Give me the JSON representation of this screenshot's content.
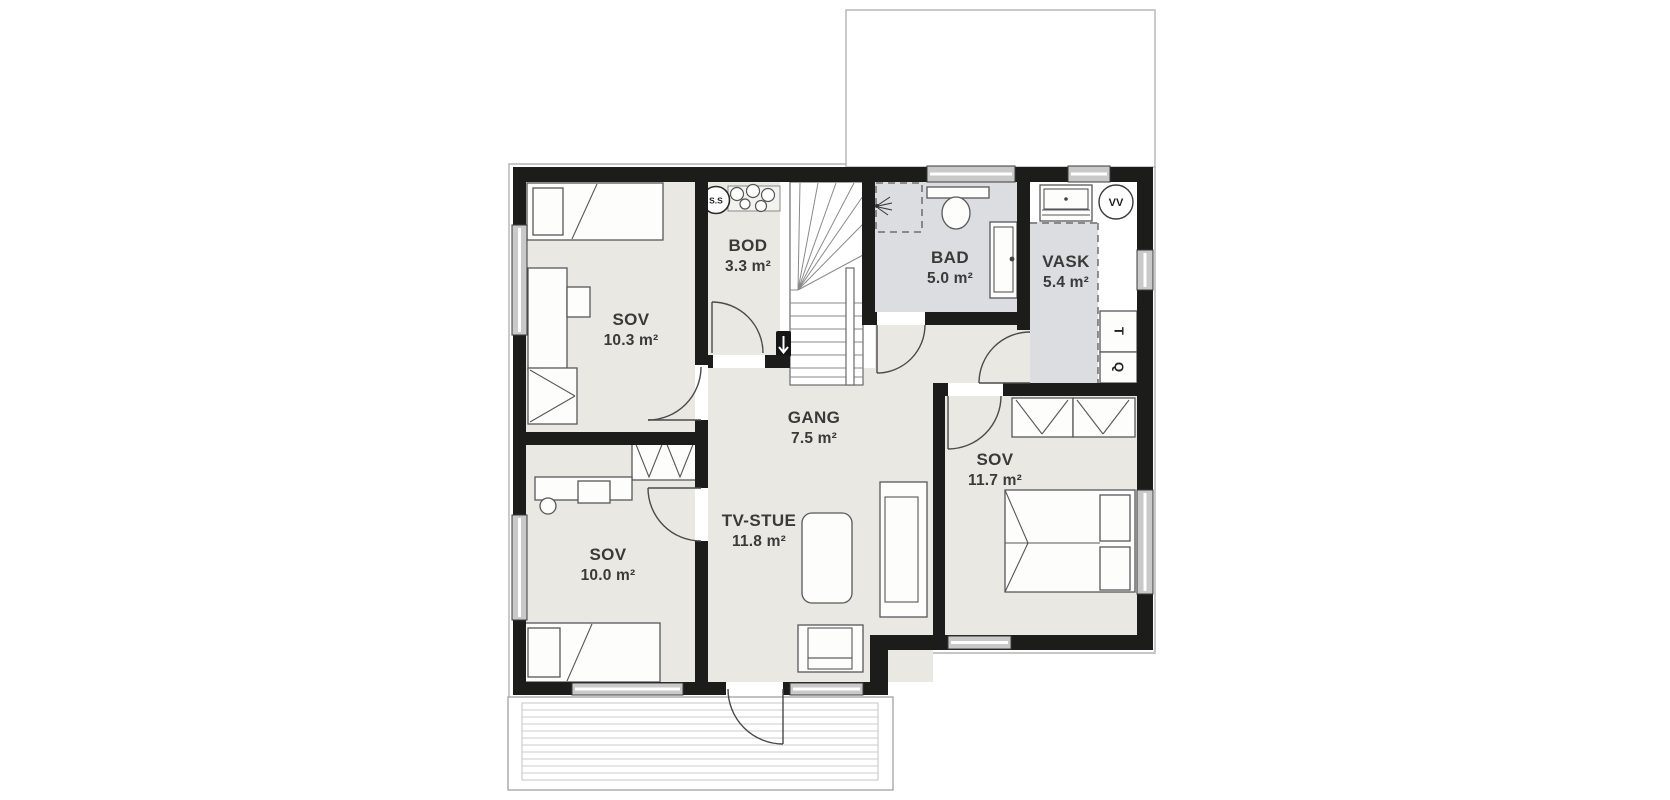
{
  "floorplan": {
    "rooms": [
      {
        "name": "SOV",
        "area": "10.3 m²"
      },
      {
        "name": "SOV",
        "area": "10.0 m²"
      },
      {
        "name": "BOD",
        "area": "3.3 m²"
      },
      {
        "name": "GANG",
        "area": "7.5 m²"
      },
      {
        "name": "TV-STUE",
        "area": "11.8 m²"
      },
      {
        "name": "BAD",
        "area": "5.0 m²"
      },
      {
        "name": "VASK",
        "area": "5.4 m²"
      },
      {
        "name": "SOV",
        "area": "11.7 m²"
      }
    ],
    "fixture_labels": {
      "water_heater": "VV",
      "storage_unit": "S.S",
      "appliance_t": "T",
      "appliance_q": "Q"
    },
    "colors": {
      "wall": "#1c1c1a",
      "floor": "#e9e8e3",
      "wet_room_floor": "#dcdde1",
      "window_fill": "#c9c9c9",
      "eave_outline": "#b3b3b3",
      "furniture_stroke": "#57575a",
      "label_text": "#3a3a39"
    }
  }
}
